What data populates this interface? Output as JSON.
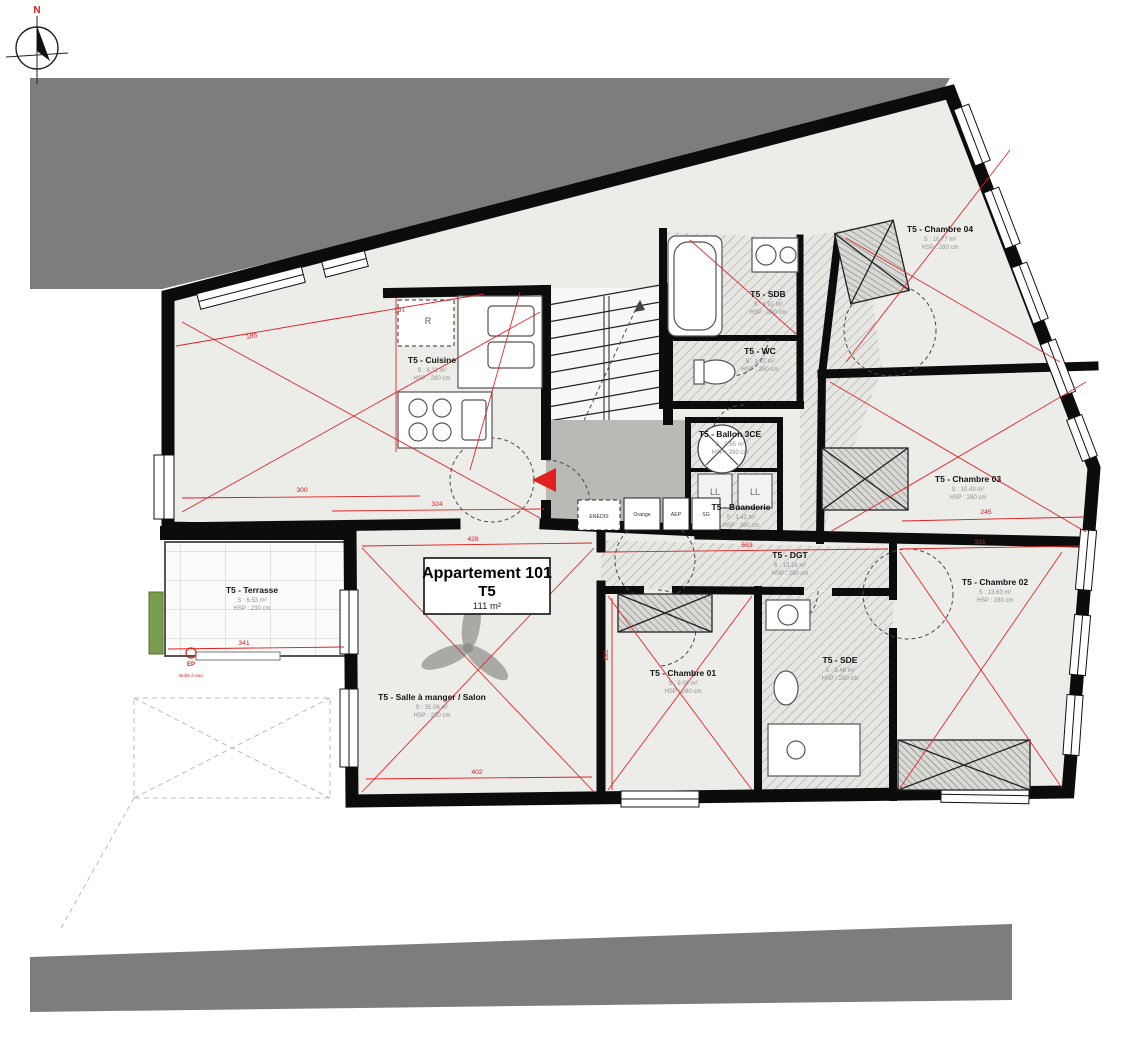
{
  "compass": {
    "north_label": "N"
  },
  "title_block": {
    "title": "Appartement 101",
    "type": "T5",
    "area": "111 m²"
  },
  "rooms": [
    {
      "name": "T5 - Cuisine",
      "area": "S : 6.11 m²",
      "height": "HSP : 280 cm"
    },
    {
      "name": "T5 - SDB",
      "area": "S : 4.91 m²",
      "height": "HSP : 280 cm"
    },
    {
      "name": "T5 - WC",
      "area": "S : 1.67 m²",
      "height": "HSP : 280 cm"
    },
    {
      "name": "T5 - Ballon 3CE",
      "area": "S : 0.85 m²",
      "height": "HSP : 280 cm"
    },
    {
      "name": "T5 - Buanderie",
      "area": "S : 1.42 m²",
      "height": "HSP : 280 cm"
    },
    {
      "name": "T5 - Chambre 04",
      "area": "S : 10.77 m²",
      "height": "HSP : 280 cm"
    },
    {
      "name": "T5 - Chambre 03",
      "area": "S : 10.43 m²",
      "height": "HSP : 280 cm"
    },
    {
      "name": "T5 - Chambre 02",
      "area": "S : 13.63 m²",
      "height": "HSP : 280 cm"
    },
    {
      "name": "T5 - Chambre 01",
      "area": "S : 9.09 m²",
      "height": "HSP : 280 cm"
    },
    {
      "name": "T5 - SDE",
      "area": "S : 5.46 m²",
      "height": "HSP : 280 cm"
    },
    {
      "name": "T5 - DGT",
      "area": "S : 10.16 m²",
      "height": "HSP : 280 cm"
    },
    {
      "name": "T5 - Terrasse",
      "area": "S : 6.53 m²",
      "height": "HSP : 230 cm"
    },
    {
      "name": "T5 - Salle à manger / Salon",
      "area": "S : 35.06 m²",
      "height": "HSP : 280 cm"
    }
  ],
  "fixtures": {
    "fridge": "R",
    "washer_1": "LL",
    "washer_2": "LL",
    "rainwater": "EP",
    "rainwater_note": "Boîte à eau",
    "utility_boxes": [
      "ENEDIS",
      "Orange",
      "AEP",
      "SG"
    ]
  },
  "dimensions": [
    "185",
    "191",
    "300",
    "324",
    "428",
    "563",
    "245",
    "331",
    "402",
    "341",
    "281"
  ],
  "colors": {
    "wall": "#0c0c0c",
    "floor": "#ecece9",
    "neighbor_mass": "#7d7d7d",
    "landing": "#b9b9b6",
    "dimension_red": "#e02020",
    "hatch": "#9a9a98",
    "greenery": "#7a9c4e"
  }
}
